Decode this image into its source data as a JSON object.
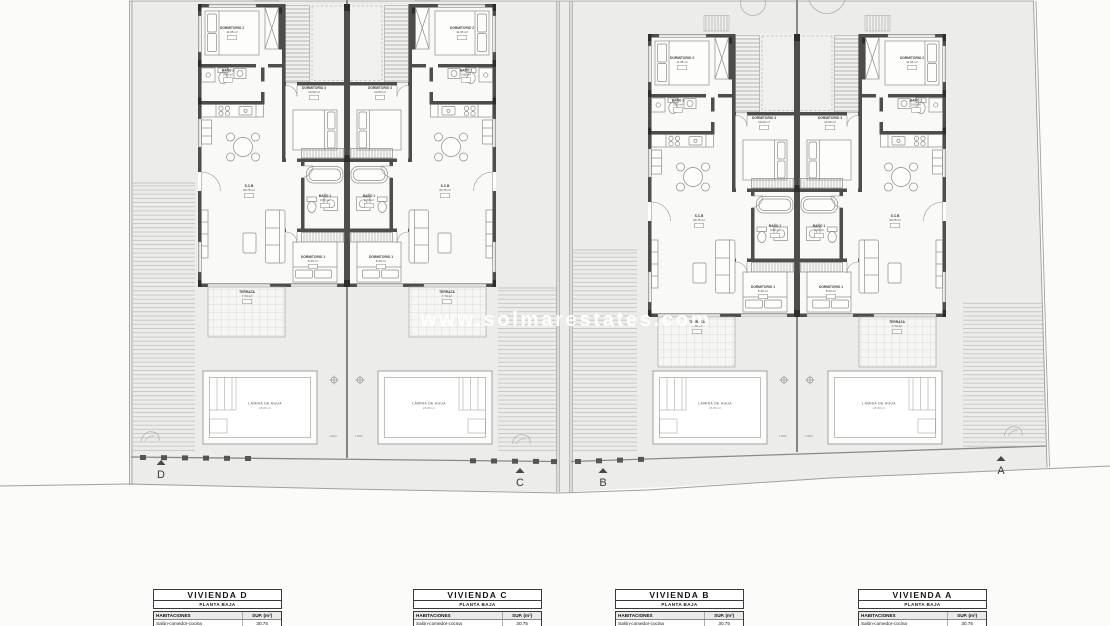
{
  "watermark": {
    "text": "www.solmarestates.com"
  },
  "rooms": {
    "dorm2": {
      "name": "DORMITORIO 2",
      "area": "11.65 m²"
    },
    "dorm3": {
      "name": "DORMITORIO 3",
      "area": "10.00 m²"
    },
    "dorm1": {
      "name": "DORMITORIO 1",
      "area": "8.30 m²"
    },
    "bano2": {
      "name": "BAÑO 2",
      "area": "3.05 m²"
    },
    "bano1": {
      "name": "BAÑO 1",
      "area": "3.60 m²"
    },
    "salon": {
      "name": "S.C.B",
      "area": "30.75 m²"
    },
    "terraza": {
      "name": "TERRAZA",
      "area": "7.70 m²"
    },
    "pool": {
      "name": "LÁMINA DE AGUA",
      "area": "23.80 m²"
    },
    "lrec": "L.REC"
  },
  "section_markers": [
    {
      "label": "D"
    },
    {
      "label": "C"
    },
    {
      "label": "B"
    },
    {
      "label": "A"
    }
  ],
  "tables": [
    {
      "title": "VIVIENDA D",
      "subtitle": "PLANTA BAJA",
      "header": [
        "HABITACIONES",
        "SUP. (m²)"
      ],
      "rows": [
        [
          "Salón-comedor-cocina",
          "30.75"
        ]
      ]
    },
    {
      "title": "VIVIENDA C",
      "subtitle": "PLANTA BAJA",
      "header": [
        "HABITACIONES",
        "SUP. (m²)"
      ],
      "rows": [
        [
          "Salón-comedor-cocina",
          "30.75"
        ]
      ]
    },
    {
      "title": "VIVIENDA B",
      "subtitle": "PLANTA BAJA",
      "header": [
        "HABITACIONES",
        "SUP. (m²)"
      ],
      "rows": [
        [
          "Salón-comedor-cocina",
          "30.75"
        ]
      ]
    },
    {
      "title": "VIVIENDA A",
      "subtitle": "PLANTA BAJA",
      "header": [
        "HABITACIONES",
        "SUP. (m²)"
      ],
      "rows": [
        [
          "Salón-comedor-cocina",
          "30.75"
        ]
      ]
    }
  ]
}
